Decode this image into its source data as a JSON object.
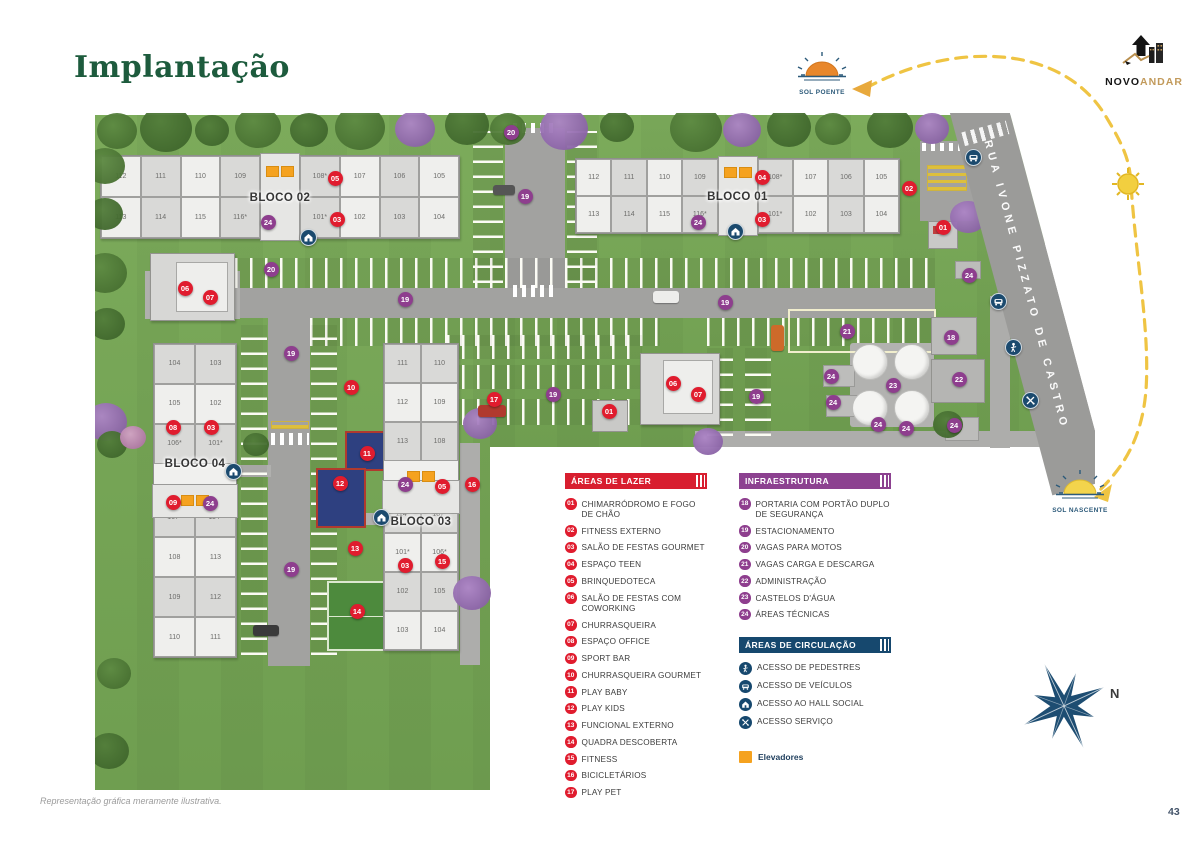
{
  "page": {
    "title": "Implantação",
    "footer_note": "Representação gráfica meramente ilustrativa.",
    "page_number": "43"
  },
  "logo": {
    "text_primary": "NOVO",
    "text_secondary": "ANDAR"
  },
  "compass": {
    "label": "N"
  },
  "suns": {
    "poente": "SOL POENTE",
    "nascente": "SOL NASCENTE"
  },
  "map": {
    "street_name": "RUA IVONE PIZZATO DE CASTRO",
    "blocks": [
      {
        "id": "bloco-01",
        "label": "BLOCO 01",
        "units_top": [
          "112",
          "111",
          "110",
          "109",
          "108*",
          "107",
          "106",
          "105"
        ],
        "units_bottom": [
          "113",
          "114",
          "115",
          "116*",
          "101*",
          "102",
          "103",
          "104"
        ]
      },
      {
        "id": "bloco-02",
        "label": "BLOCO 02",
        "units_top": [
          "112",
          "111",
          "110",
          "109",
          "108*",
          "107",
          "106",
          "105"
        ],
        "units_bottom": [
          "113",
          "114",
          "115",
          "116*",
          "101*",
          "102",
          "103",
          "104"
        ]
      },
      {
        "id": "bloco-03",
        "label": "BLOCO 03",
        "units_left": [
          "111",
          "112",
          "113",
          "114*",
          "101*",
          "102",
          "103"
        ],
        "units_right": [
          "110",
          "109",
          "108",
          "107*",
          "106*",
          "105",
          "104"
        ]
      },
      {
        "id": "bloco-04",
        "label": "BLOCO 04",
        "units_left": [
          "104",
          "105",
          "106*",
          "107*",
          "108",
          "109",
          "110"
        ],
        "units_right": [
          "103",
          "102",
          "101*",
          "114*",
          "113",
          "112",
          "111"
        ]
      }
    ],
    "markers": [
      {
        "num": "05",
        "type": "lazer",
        "x": 240,
        "y": 65
      },
      {
        "num": "03",
        "type": "lazer",
        "x": 242,
        "y": 106
      },
      {
        "num": "24",
        "type": "infra",
        "x": 173,
        "y": 109
      },
      {
        "num": "04",
        "type": "lazer",
        "x": 667,
        "y": 64
      },
      {
        "num": "03",
        "type": "lazer",
        "x": 667,
        "y": 106
      },
      {
        "num": "24",
        "type": "infra",
        "x": 603,
        "y": 109
      },
      {
        "num": "02",
        "type": "lazer",
        "x": 814,
        "y": 75
      },
      {
        "num": "20",
        "type": "infra",
        "x": 416,
        "y": 19
      },
      {
        "num": "19",
        "type": "infra",
        "x": 430,
        "y": 83
      },
      {
        "num": "06",
        "type": "lazer",
        "x": 90,
        "y": 175
      },
      {
        "num": "07",
        "type": "lazer",
        "x": 115,
        "y": 184
      },
      {
        "num": "20",
        "type": "infra",
        "x": 176,
        "y": 156
      },
      {
        "num": "19",
        "type": "infra",
        "x": 310,
        "y": 186
      },
      {
        "num": "19",
        "type": "infra",
        "x": 630,
        "y": 189
      },
      {
        "num": "21",
        "type": "infra",
        "x": 752,
        "y": 218
      },
      {
        "num": "01",
        "type": "lazer",
        "x": 848,
        "y": 114
      },
      {
        "num": "24",
        "type": "infra",
        "x": 874,
        "y": 162
      },
      {
        "num": "18",
        "type": "infra",
        "x": 856,
        "y": 224
      },
      {
        "num": "22",
        "type": "infra",
        "x": 864,
        "y": 266
      },
      {
        "num": "23",
        "type": "infra",
        "x": 798,
        "y": 272
      },
      {
        "num": "24",
        "type": "infra",
        "x": 736,
        "y": 263
      },
      {
        "num": "24",
        "type": "infra",
        "x": 738,
        "y": 289
      },
      {
        "num": "24",
        "type": "infra",
        "x": 783,
        "y": 311
      },
      {
        "num": "24",
        "type": "infra",
        "x": 811,
        "y": 315
      },
      {
        "num": "24",
        "type": "infra",
        "x": 859,
        "y": 312
      },
      {
        "num": "06",
        "type": "lazer",
        "x": 578,
        "y": 270
      },
      {
        "num": "07",
        "type": "lazer",
        "x": 603,
        "y": 281
      },
      {
        "num": "01",
        "type": "lazer",
        "x": 514,
        "y": 298
      },
      {
        "num": "17",
        "type": "lazer",
        "x": 399,
        "y": 286
      },
      {
        "num": "19",
        "type": "infra",
        "x": 458,
        "y": 281
      },
      {
        "num": "19",
        "type": "infra",
        "x": 661,
        "y": 283
      },
      {
        "num": "19",
        "type": "infra",
        "x": 196,
        "y": 240
      },
      {
        "num": "19",
        "type": "infra",
        "x": 196,
        "y": 456
      },
      {
        "num": "10",
        "type": "lazer",
        "x": 256,
        "y": 274
      },
      {
        "num": "11",
        "type": "lazer",
        "x": 272,
        "y": 340
      },
      {
        "num": "12",
        "type": "lazer",
        "x": 245,
        "y": 370
      },
      {
        "num": "13",
        "type": "lazer",
        "x": 260,
        "y": 435
      },
      {
        "num": "14",
        "type": "lazer",
        "x": 262,
        "y": 498
      },
      {
        "num": "08",
        "type": "lazer",
        "x": 78,
        "y": 314
      },
      {
        "num": "03",
        "type": "lazer",
        "x": 116,
        "y": 314
      },
      {
        "num": "09",
        "type": "lazer",
        "x": 78,
        "y": 389
      },
      {
        "num": "24",
        "type": "infra",
        "x": 115,
        "y": 390
      },
      {
        "num": "24",
        "type": "infra",
        "x": 310,
        "y": 371
      },
      {
        "num": "05",
        "type": "lazer",
        "x": 347,
        "y": 373
      },
      {
        "num": "16",
        "type": "lazer",
        "x": 377,
        "y": 371
      },
      {
        "num": "03",
        "type": "lazer",
        "x": 310,
        "y": 452
      },
      {
        "num": "15",
        "type": "lazer",
        "x": 347,
        "y": 448
      }
    ],
    "access_icons": [
      {
        "icon": "hall-social",
        "x": 213,
        "y": 124
      },
      {
        "icon": "hall-social",
        "x": 640,
        "y": 118
      },
      {
        "icon": "hall-social",
        "x": 138,
        "y": 358
      },
      {
        "icon": "hall-social",
        "x": 286,
        "y": 404
      },
      {
        "icon": "vehicle",
        "x": 878,
        "y": 44
      },
      {
        "icon": "vehicle",
        "x": 903,
        "y": 188
      },
      {
        "icon": "pedestrian",
        "x": 918,
        "y": 234
      },
      {
        "icon": "service",
        "x": 935,
        "y": 287
      }
    ]
  },
  "legend": {
    "lazer": {
      "title": "ÁREAS DE LAZER",
      "color": "#d81e2f",
      "items": [
        {
          "num": "01",
          "label": "CHIMARRÓDROMO E FOGO DE CHÃO"
        },
        {
          "num": "02",
          "label": "FITNESS EXTERNO"
        },
        {
          "num": "03",
          "label": "SALÃO DE FESTAS GOURMET"
        },
        {
          "num": "04",
          "label": "ESPAÇO TEEN"
        },
        {
          "num": "05",
          "label": "BRINQUEDOTECA"
        },
        {
          "num": "06",
          "label": "SALÃO DE FESTAS COM COWORKING"
        },
        {
          "num": "07",
          "label": "CHURRASQUEIRA"
        },
        {
          "num": "08",
          "label": "ESPAÇO OFFICE"
        },
        {
          "num": "09",
          "label": "SPORT BAR"
        },
        {
          "num": "10",
          "label": "CHURRASQUEIRA GOURMET"
        },
        {
          "num": "11",
          "label": "PLAY BABY"
        },
        {
          "num": "12",
          "label": "PLAY KIDS"
        },
        {
          "num": "13",
          "label": "FUNCIONAL EXTERNO"
        },
        {
          "num": "14",
          "label": "QUADRA DESCOBERTA"
        },
        {
          "num": "15",
          "label": "FITNESS"
        },
        {
          "num": "16",
          "label": "BICICLETÁRIOS"
        },
        {
          "num": "17",
          "label": "PLAY PET"
        }
      ]
    },
    "infra": {
      "title": "INFRAESTRUTURA",
      "color": "#8c4190",
      "items": [
        {
          "num": "18",
          "label": "PORTARIA COM PORTÃO DUPLO DE SEGURANÇA"
        },
        {
          "num": "19",
          "label": "ESTACIONAMENTO"
        },
        {
          "num": "20",
          "label": "VAGAS PARA MOTOS"
        },
        {
          "num": "21",
          "label": "VAGAS CARGA E DESCARGA"
        },
        {
          "num": "22",
          "label": "ADMINISTRAÇÃO"
        },
        {
          "num": "23",
          "label": "CASTELOS D'ÁGUA"
        },
        {
          "num": "24",
          "label": "ÁREAS TÉCNICAS"
        }
      ]
    },
    "circulacao": {
      "title": "ÁREAS DE CIRCULAÇÃO",
      "color": "#16486e",
      "items": [
        {
          "icon": "pedestrian",
          "label": "ACESSO DE PEDESTRES"
        },
        {
          "icon": "vehicle",
          "label": "ACESSO DE VEÍCULOS"
        },
        {
          "icon": "hall-social",
          "label": "ACESSO AO HALL SOCIAL"
        },
        {
          "icon": "service",
          "label": "ACESSO SERVIÇO"
        }
      ]
    },
    "elevators": {
      "label": "Elevadores",
      "color": "#f5a21f"
    }
  }
}
